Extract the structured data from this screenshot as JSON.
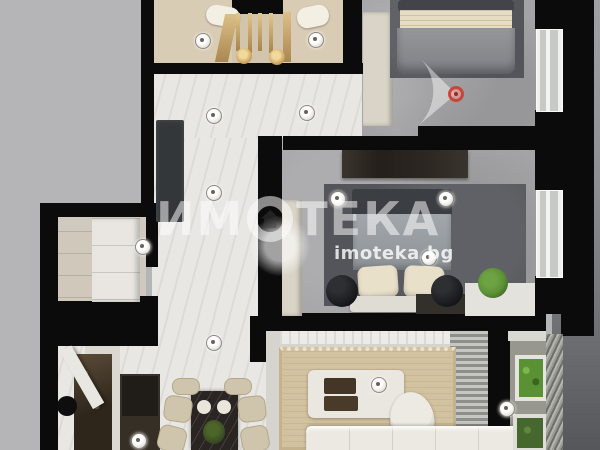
{
  "watermark": {
    "brand_full": "ИМОТЕКА",
    "brand_prefix": "ИМ",
    "brand_suffix": "ТЕКА",
    "url": "imoteka.bg"
  },
  "colors": {
    "bg": "#b5b5b7",
    "wall": "#0b0b0b",
    "bath": "#d9ccb5",
    "wm": "rgba(255,255,255,0.52)",
    "marble_floor": "#e9e7e3",
    "concrete_floor": "#a4a4a6",
    "brass": "#c9a96a",
    "rug_dark": "#54555a",
    "rug_living": "#d2c2a0",
    "plant_green": "#5a9135",
    "sensor_red": "#c33e32"
  },
  "markers": {
    "spotlights": [
      [
        202,
        40
      ],
      [
        315,
        39
      ],
      [
        213,
        115
      ],
      [
        306,
        112
      ],
      [
        213,
        192
      ],
      [
        142,
        246
      ],
      [
        337,
        198
      ],
      [
        445,
        198
      ],
      [
        428,
        257
      ],
      [
        213,
        342
      ],
      [
        378,
        384
      ],
      [
        506,
        408
      ],
      [
        138,
        440
      ]
    ],
    "sensor": {
      "x": 456,
      "y": 94
    }
  }
}
